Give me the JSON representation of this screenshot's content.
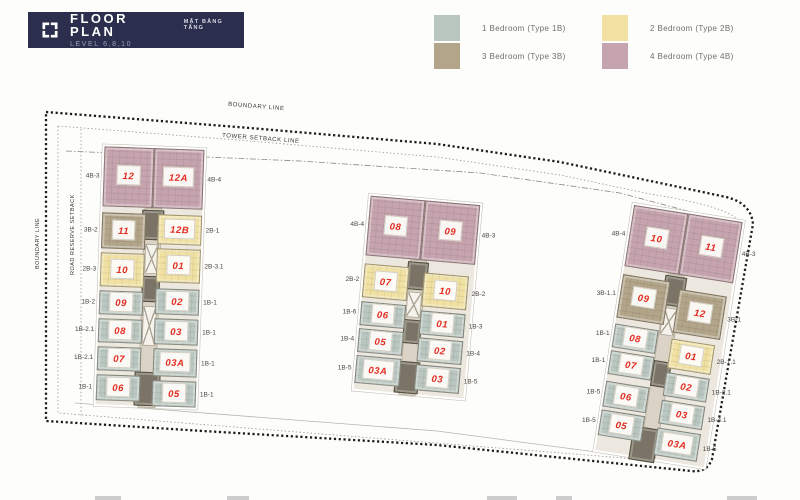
{
  "header": {
    "title": "FLOOR PLAN",
    "subtitle": "MẶT BẰNG TẦNG",
    "level": "LEVEL 6,8,10",
    "bg_color": "#2c2e4e"
  },
  "legend": {
    "items": [
      {
        "code": "1B",
        "label": "1 Bedroom (Type 1B)",
        "color": "#bac7c1"
      },
      {
        "code": "2B",
        "label": "2 Bedroom (Type 2B)",
        "color": "#f1e2a4"
      },
      {
        "code": "3B",
        "label": "3 Bedroom (Type 3B)",
        "color": "#b2a58a"
      },
      {
        "code": "4B",
        "label": "4 Bedroom (Type 4B)",
        "color": "#c6a4af"
      }
    ]
  },
  "site": {
    "labels": {
      "boundary_top": "BOUNDARY LINE",
      "boundary_left": "BOUNDARY LINE",
      "tower_setback": "TOWER SETBACK LINE",
      "road_reserve": "ROAD RESERVE SETBACK"
    }
  },
  "unit_colors": {
    "1B": "#bac7c1",
    "2B": "#f1e2a4",
    "3B": "#b2a58a",
    "4B": "#c6a4af"
  },
  "number_color": "#e32b20",
  "buildings": [
    {
      "id": "left",
      "x": 100,
      "y": 148,
      "w": 100,
      "h": 258,
      "rotate": 2,
      "core": [
        {
          "x": 42,
          "y": 60,
          "w": 16,
          "h": 198,
          "shade": "light"
        },
        {
          "x": 40,
          "y": 62,
          "w": 20,
          "h": 28,
          "shade": "dark"
        },
        {
          "x": 44,
          "y": 96,
          "w": 12,
          "h": 28,
          "shade": "x"
        },
        {
          "x": 42,
          "y": 128,
          "w": 16,
          "h": 24,
          "shade": "dark"
        },
        {
          "x": 44,
          "y": 158,
          "w": 12,
          "h": 38,
          "shade": "x"
        },
        {
          "x": 38,
          "y": 224,
          "w": 24,
          "h": 32,
          "shade": "dark"
        }
      ],
      "tiles": [
        {
          "no": "12",
          "type": "4B",
          "x": 0,
          "y": 0,
          "w": 50,
          "h": 60,
          "label": "4B-3",
          "side": "left"
        },
        {
          "no": "12A",
          "type": "4B",
          "x": 50,
          "y": 0,
          "w": 50,
          "h": 60,
          "label": "4B-4",
          "side": "right"
        },
        {
          "no": "11",
          "type": "3B",
          "x": 0,
          "y": 66,
          "w": 44,
          "h": 36,
          "label": "3B-2",
          "side": "left"
        },
        {
          "no": "12B",
          "type": "2B",
          "x": 56,
          "y": 66,
          "w": 44,
          "h": 30,
          "label": "2B-1",
          "side": "right"
        },
        {
          "no": "10",
          "type": "2B",
          "x": 0,
          "y": 106,
          "w": 44,
          "h": 34,
          "label": "2B-3",
          "side": "left"
        },
        {
          "no": "01",
          "type": "2B",
          "x": 56,
          "y": 100,
          "w": 44,
          "h": 34,
          "label": "2B-3.1",
          "side": "right"
        },
        {
          "no": "09",
          "type": "1B",
          "x": 0,
          "y": 144,
          "w": 44,
          "h": 24,
          "label": "1B-2",
          "side": "left"
        },
        {
          "no": "02",
          "type": "1B",
          "x": 56,
          "y": 140,
          "w": 44,
          "h": 26,
          "label": "1B-1",
          "side": "right"
        },
        {
          "no": "08",
          "type": "1B",
          "x": 0,
          "y": 172,
          "w": 44,
          "h": 24,
          "label": "1B-2.1",
          "side": "left"
        },
        {
          "no": "03",
          "type": "1B",
          "x": 56,
          "y": 170,
          "w": 44,
          "h": 26,
          "label": "1B-1",
          "side": "right"
        },
        {
          "no": "07",
          "type": "1B",
          "x": 0,
          "y": 200,
          "w": 44,
          "h": 24,
          "label": "1B-2.1",
          "side": "left"
        },
        {
          "no": "03A",
          "type": "1B",
          "x": 56,
          "y": 200,
          "w": 44,
          "h": 28,
          "label": "1B-1",
          "side": "right"
        },
        {
          "no": "06",
          "type": "1B",
          "x": 0,
          "y": 228,
          "w": 44,
          "h": 26,
          "label": "1B-1",
          "side": "left"
        },
        {
          "no": "05",
          "type": "1B",
          "x": 56,
          "y": 232,
          "w": 44,
          "h": 26,
          "label": "1B-1",
          "side": "right"
        }
      ]
    },
    {
      "id": "middle",
      "x": 362,
      "y": 200,
      "w": 110,
      "h": 194,
      "rotate": 5,
      "core": [
        {
          "x": 45,
          "y": 60,
          "w": 15,
          "h": 134,
          "shade": "light"
        },
        {
          "x": 43,
          "y": 62,
          "w": 19,
          "h": 26,
          "shade": "dark"
        },
        {
          "x": 45,
          "y": 92,
          "w": 13,
          "h": 24,
          "shade": "x"
        },
        {
          "x": 44,
          "y": 120,
          "w": 16,
          "h": 22,
          "shade": "dark"
        },
        {
          "x": 40,
          "y": 162,
          "w": 22,
          "h": 30,
          "shade": "dark"
        }
      ],
      "tiles": [
        {
          "no": "08",
          "type": "4B",
          "x": 0,
          "y": 0,
          "w": 55,
          "h": 60,
          "label": "4B-4",
          "side": "left"
        },
        {
          "no": "09",
          "type": "4B",
          "x": 55,
          "y": 0,
          "w": 55,
          "h": 60,
          "label": "4B-3",
          "side": "right"
        },
        {
          "no": "07",
          "type": "2B",
          "x": 0,
          "y": 68,
          "w": 45,
          "h": 34,
          "label": "2B-2",
          "side": "left"
        },
        {
          "no": "10",
          "type": "2B",
          "x": 60,
          "y": 72,
          "w": 45,
          "h": 34,
          "label": "2B-2",
          "side": "right"
        },
        {
          "no": "06",
          "type": "1B",
          "x": 0,
          "y": 106,
          "w": 45,
          "h": 24,
          "label": "1B-6",
          "side": "left"
        },
        {
          "no": "01",
          "type": "1B",
          "x": 60,
          "y": 110,
          "w": 45,
          "h": 24,
          "label": "1B-3",
          "side": "right"
        },
        {
          "no": "05",
          "type": "1B",
          "x": 0,
          "y": 133,
          "w": 45,
          "h": 24,
          "label": "1B-4",
          "side": "left"
        },
        {
          "no": "02",
          "type": "1B",
          "x": 60,
          "y": 137,
          "w": 45,
          "h": 24,
          "label": "1B-4",
          "side": "right"
        },
        {
          "no": "03A",
          "type": "1B",
          "x": 0,
          "y": 160,
          "w": 45,
          "h": 28,
          "label": "1B-5",
          "side": "left"
        },
        {
          "no": "03",
          "type": "1B",
          "x": 60,
          "y": 164,
          "w": 45,
          "h": 26,
          "label": "1B-5",
          "side": "right"
        }
      ]
    },
    {
      "id": "right",
      "x": 614,
      "y": 212,
      "w": 110,
      "h": 248,
      "rotate": 9,
      "core": [
        {
          "x": 44,
          "y": 62,
          "w": 15,
          "h": 184,
          "shade": "light"
        },
        {
          "x": 42,
          "y": 64,
          "w": 20,
          "h": 28,
          "shade": "dark"
        },
        {
          "x": 45,
          "y": 96,
          "w": 13,
          "h": 26,
          "shade": "x"
        },
        {
          "x": 44,
          "y": 150,
          "w": 16,
          "h": 24,
          "shade": "dark"
        },
        {
          "x": 34,
          "y": 218,
          "w": 24,
          "h": 32,
          "shade": "dark"
        }
      ],
      "tiles": [
        {
          "no": "10",
          "type": "4B",
          "x": 0,
          "y": 0,
          "w": 55,
          "h": 62,
          "label": "4B-4",
          "side": "left"
        },
        {
          "no": "11",
          "type": "4B",
          "x": 55,
          "y": 0,
          "w": 55,
          "h": 62,
          "label": "4B-3",
          "side": "right"
        },
        {
          "no": "09",
          "type": "3B",
          "x": 0,
          "y": 70,
          "w": 48,
          "h": 44,
          "label": "3B-1.1",
          "side": "left"
        },
        {
          "no": "12",
          "type": "3B",
          "x": 58,
          "y": 76,
          "w": 48,
          "h": 44,
          "label": "3B-1",
          "side": "right"
        },
        {
          "no": "08",
          "type": "1B",
          "x": 0,
          "y": 120,
          "w": 44,
          "h": 24,
          "label": "1B-1",
          "side": "left"
        },
        {
          "no": "01",
          "type": "2B",
          "x": 58,
          "y": 126,
          "w": 44,
          "h": 30,
          "label": "2B-1.1",
          "side": "right"
        },
        {
          "no": "07",
          "type": "1B",
          "x": 0,
          "y": 147,
          "w": 44,
          "h": 24,
          "label": "1B-1",
          "side": "left"
        },
        {
          "no": "02",
          "type": "1B",
          "x": 58,
          "y": 160,
          "w": 44,
          "h": 24,
          "label": "1B-2.1",
          "side": "right"
        },
        {
          "no": "06",
          "type": "1B",
          "x": 0,
          "y": 178,
          "w": 44,
          "h": 26,
          "label": "1B-5",
          "side": "left"
        },
        {
          "no": "03",
          "type": "1B",
          "x": 58,
          "y": 188,
          "w": 44,
          "h": 24,
          "label": "1B-4.1",
          "side": "right"
        },
        {
          "no": "05",
          "type": "1B",
          "x": 0,
          "y": 207,
          "w": 44,
          "h": 26,
          "label": "1B-5",
          "side": "left"
        },
        {
          "no": "03A",
          "type": "1B",
          "x": 58,
          "y": 216,
          "w": 44,
          "h": 28,
          "label": "1B-5",
          "side": "right"
        }
      ]
    }
  ]
}
